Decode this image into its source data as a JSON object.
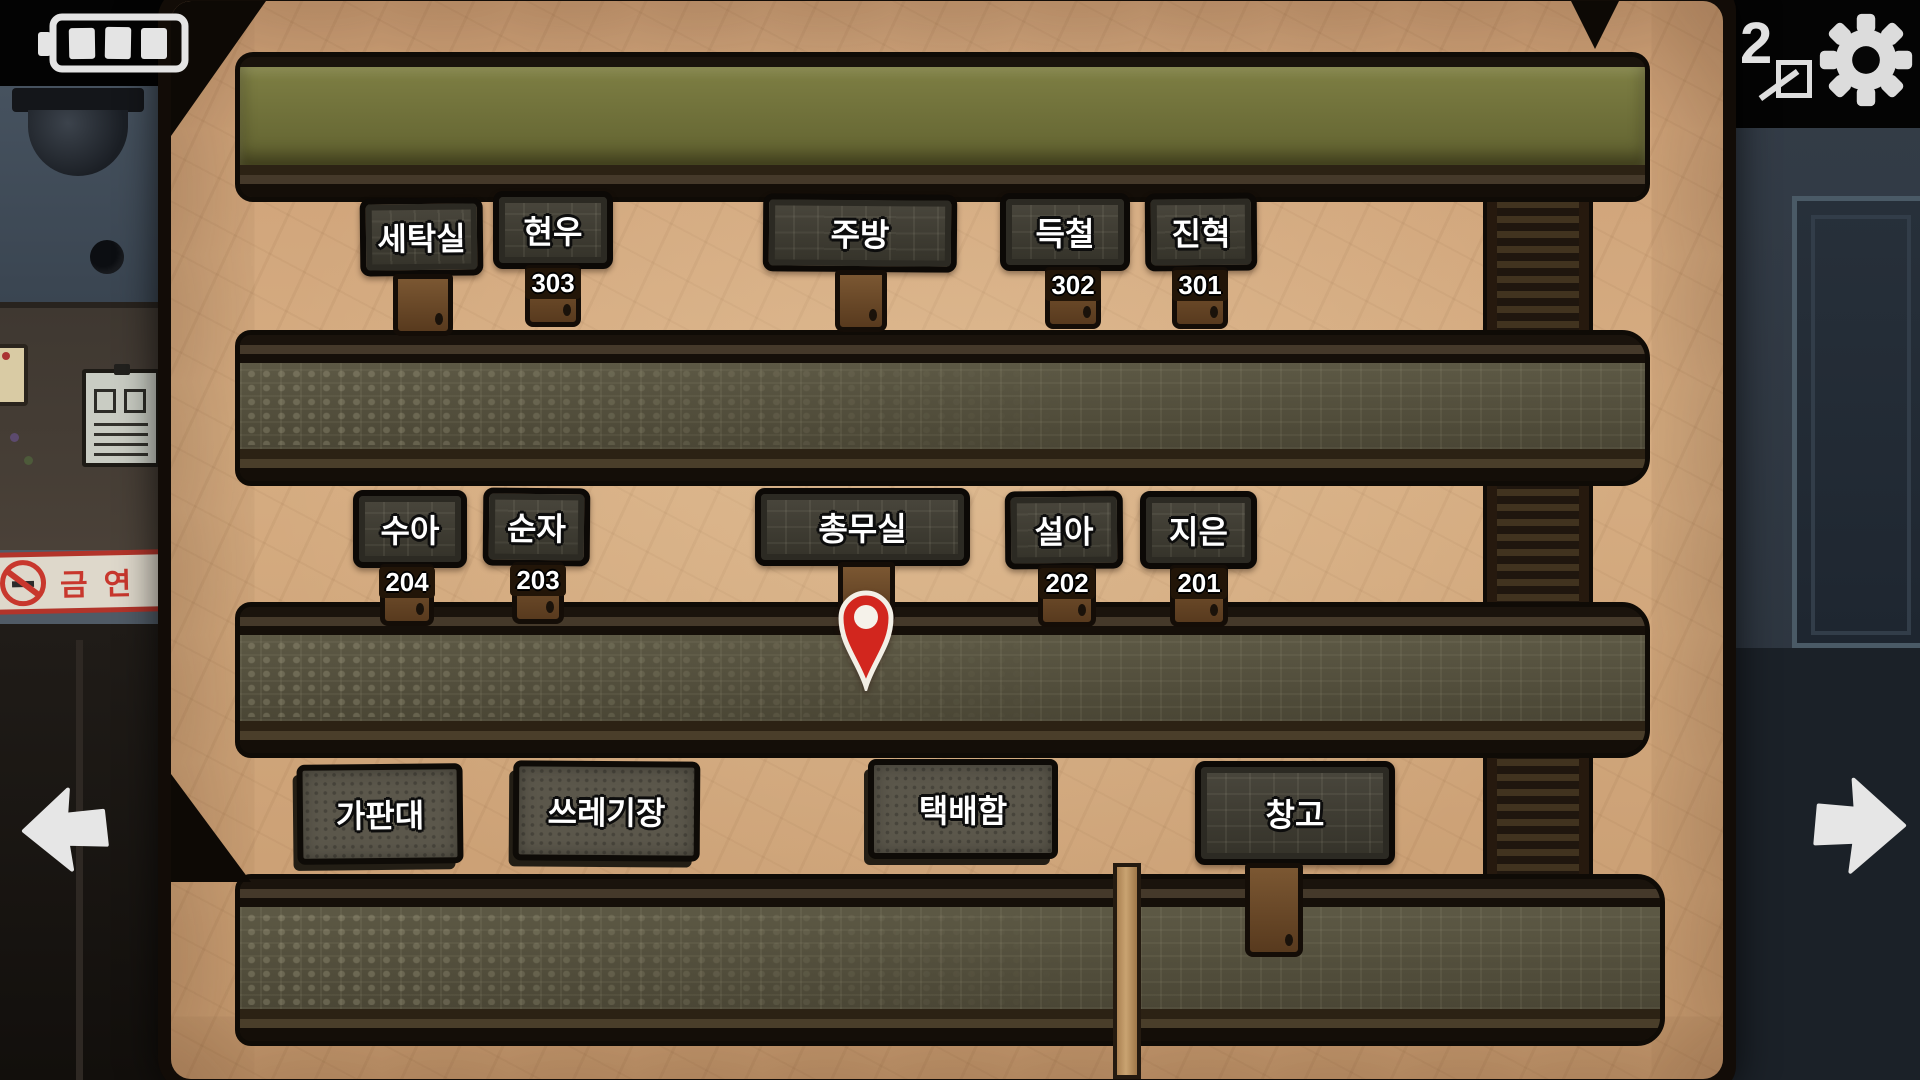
{
  "hud": {
    "battery": {
      "icon": "battery-3-bars",
      "bars": 3
    },
    "photo_counter": {
      "icon": "photo-frame",
      "count": "2"
    },
    "settings": {
      "icon": "gear"
    },
    "nav": {
      "prev_icon": "arrow-left",
      "next_icon": "arrow-right"
    }
  },
  "scene": {
    "camera_icon": "cctv-dome-camera",
    "bulletin_board_icon": "notice-paper",
    "no_smoking_sign": {
      "text": "금연",
      "icon": "no-smoking",
      "color": "#c8372d"
    }
  },
  "map": {
    "marker": {
      "icon": "location-pin",
      "color": "#d2261e"
    },
    "colors": {
      "parchment": "#d0a478",
      "roof_bar": "#74753a",
      "sign_text": "#ffffff"
    },
    "floor3": {
      "rooms": [
        {
          "label": "세탁실"
        },
        {
          "label": "현우",
          "number": "303"
        },
        {
          "label": "주방"
        },
        {
          "label": "득철",
          "number": "302"
        },
        {
          "label": "진혁",
          "number": "301"
        }
      ]
    },
    "floor2": {
      "rooms": [
        {
          "label": "수아",
          "number": "204"
        },
        {
          "label": "순자",
          "number": "203"
        },
        {
          "label": "총무실"
        },
        {
          "label": "설아",
          "number": "202"
        },
        {
          "label": "지은",
          "number": "201"
        }
      ]
    },
    "ground": {
      "rooms": [
        {
          "label": "가판대"
        },
        {
          "label": "쓰레기장"
        },
        {
          "label": "택배함"
        },
        {
          "label": "창고"
        }
      ]
    }
  }
}
